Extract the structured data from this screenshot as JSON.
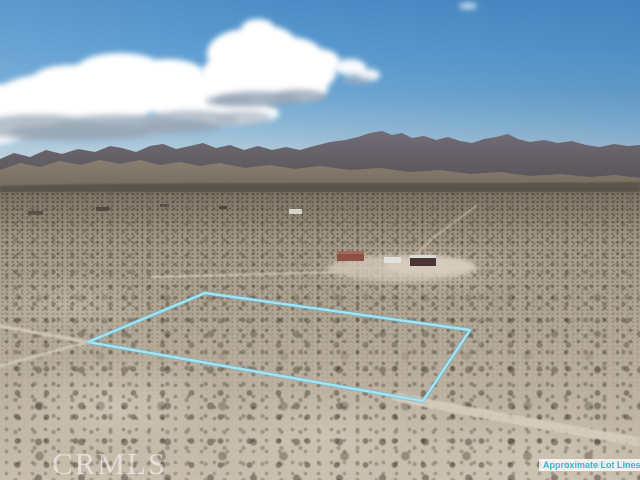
{
  "watermark": {
    "text": "CRMLS"
  },
  "lot_label": {
    "text": "Approximate Lot Lines",
    "text_color": "#35b6ce",
    "background": "rgba(255,255,255,0.78)"
  },
  "lot_boundary": {
    "points": "88,342 205,293 470,330 423,401",
    "line_color": "#8fdef2"
  },
  "scene": {
    "type": "aerial-desert-parcel-photo",
    "sky_zenith_color": "#4d8dc6",
    "sky_horizon_color": "#c6d4dc",
    "cloud_color": "#ffffff",
    "mountain_color": "#5e5a62",
    "scrub_color": "#958c7c",
    "sand_color": "#c3b8a8",
    "road_color": "#d6ccbd",
    "buildings": [
      {
        "name": "red-roof-house"
      },
      {
        "name": "white-trailer"
      },
      {
        "name": "dark-metal-building"
      }
    ]
  }
}
